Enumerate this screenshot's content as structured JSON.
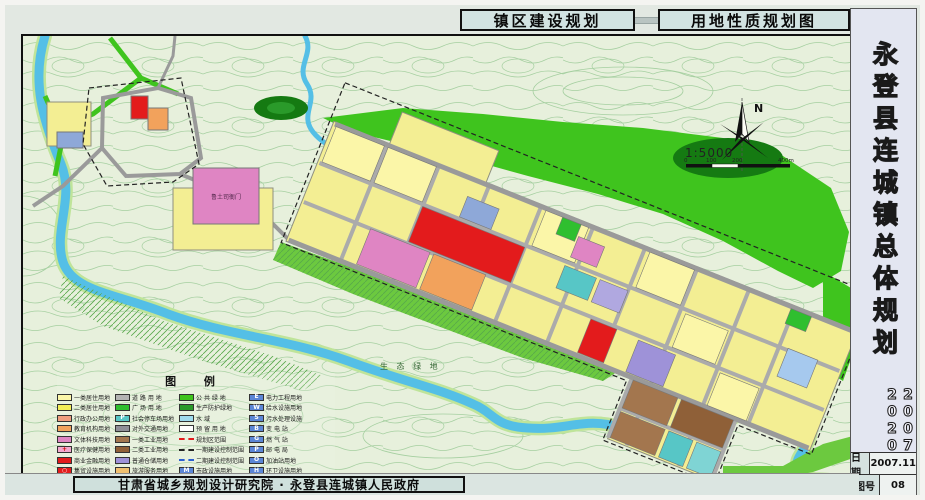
{
  "titles": {
    "construction": "镇区建设规划",
    "landuse": "用地性质规划图"
  },
  "sidebar": {
    "title": "永登县连城镇总体规划",
    "period": "2007—2020",
    "info": [
      {
        "label": "日期",
        "value": "2007.11"
      },
      {
        "label": "图号",
        "value": "08"
      }
    ]
  },
  "footer": {
    "credit": "甘肃省城乡规划设计研究院 · 永登县连城镇人民政府"
  },
  "compass": {
    "north": "N",
    "scale": "1:5000",
    "ticks": [
      "0",
      "100",
      "200",
      "400m"
    ]
  },
  "map_labels": {
    "historic_site": "鲁土司衙门",
    "eco_green": "生 态 绿 地"
  },
  "colors": {
    "residential1": "#fbf6a8",
    "residential2": "#f3ee58",
    "commercial_red": "#e31b1c",
    "culture_pink": "#df85c3",
    "education_orange": "#f2a25c",
    "green_public": "#3fc41e",
    "water": "#54bfe6",
    "road_gray": "#ababab",
    "industry_brown": "#a3764e",
    "storage_purple": "#9e92d8",
    "municipal_blue": "#5b86d6"
  },
  "legend": {
    "title": "图  例",
    "columns": [
      {
        "items": [
          {
            "label": "一类居住用地",
            "kind": "fill",
            "color": "#fbf6a8"
          },
          {
            "label": "二类居住用地",
            "kind": "fill",
            "color": "#f3ee58"
          },
          {
            "label": "行政办公用地",
            "kind": "fill",
            "color": "#ef9e80"
          },
          {
            "label": "教育机构用地",
            "kind": "fill",
            "color": "#f2a25c"
          },
          {
            "label": "文体科技用地",
            "kind": "fill",
            "color": "#df85c3"
          },
          {
            "label": "医疗保健用地",
            "kind": "sym",
            "color": "#f4a9cf",
            "sym": "+",
            "symColor": "#cc0000"
          },
          {
            "label": "商业金融用地",
            "kind": "fill",
            "color": "#e31b1c"
          },
          {
            "label": "集贸设施用地",
            "kind": "sym",
            "color": "#e31b1c",
            "sym": "○",
            "symColor": "#ffffff"
          }
        ]
      },
      {
        "items": [
          {
            "label": "道 路 用 地",
            "kind": "fill",
            "color": "#b3b3b3"
          },
          {
            "label": "广 场 用 地",
            "kind": "fill",
            "color": "#2fbf2f"
          },
          {
            "label": "社会停车场用地",
            "kind": "sym",
            "color": "#57c6c6",
            "sym": "P",
            "symColor": "#ffffff"
          },
          {
            "label": "对外交通用地",
            "kind": "fill",
            "color": "#8f8f97"
          },
          {
            "label": "一类工业用地",
            "kind": "fill",
            "color": "#a3764e"
          },
          {
            "label": "二类工业用地",
            "kind": "fill",
            "color": "#8f6038"
          },
          {
            "label": "普通仓储用地",
            "kind": "fill",
            "color": "#9e92d8"
          },
          {
            "label": "旅游服务用地",
            "kind": "fill",
            "color": "#f0c070"
          }
        ]
      },
      {
        "items": [
          {
            "label": "公 共 绿 地",
            "kind": "fill",
            "color": "#3fc41e"
          },
          {
            "label": "生产防护绿地",
            "kind": "fill",
            "color": "#2a9a2a"
          },
          {
            "label": "水    域",
            "kind": "fill",
            "color": "#9fdbee"
          },
          {
            "label": "预 留 用 地",
            "kind": "fill",
            "color": "#ffffff"
          },
          {
            "label": "规划区范围",
            "kind": "line",
            "dash": "2px dashed #e31b1c"
          },
          {
            "label": "一期建设控制范围",
            "kind": "line",
            "dash": "2px dashed #222222"
          },
          {
            "label": "二期建设控制范围",
            "kind": "line",
            "dash": "2px dashed #2b5fd0"
          },
          {
            "label": "市政设施用地",
            "kind": "sym",
            "color": "#5b86d6",
            "sym": "M",
            "symColor": "#ffffff"
          }
        ]
      },
      {
        "items": [
          {
            "label": "电力工程用地",
            "kind": "sym",
            "color": "#5b86d6",
            "sym": "E",
            "symColor": "#ffffff"
          },
          {
            "label": "给水设施用地",
            "kind": "sym",
            "color": "#5b86d6",
            "sym": "W",
            "symColor": "#ffffff"
          },
          {
            "label": "污水处理设施",
            "kind": "sym",
            "color": "#5b86d6",
            "sym": "S",
            "symColor": "#ffffff"
          },
          {
            "label": "变 电 站",
            "kind": "sym",
            "color": "#5b86d6",
            "sym": "B",
            "symColor": "#ffffff"
          },
          {
            "label": "燃 气 站",
            "kind": "sym",
            "color": "#5b86d6",
            "sym": "G",
            "symColor": "#ffffff"
          },
          {
            "label": "邮 电 局",
            "kind": "sym",
            "color": "#5b86d6",
            "sym": "P",
            "symColor": "#ffffff"
          },
          {
            "label": "加油站用地",
            "kind": "sym",
            "color": "#5b86d6",
            "sym": "O",
            "symColor": "#ffffff"
          },
          {
            "label": "环卫设施用地",
            "kind": "sym",
            "color": "#5b86d6",
            "sym": "H",
            "symColor": "#ffffff"
          },
          {
            "label": "过境道路红线范围",
            "kind": "hatch",
            "color": "#e31b1c"
          }
        ]
      }
    ]
  }
}
